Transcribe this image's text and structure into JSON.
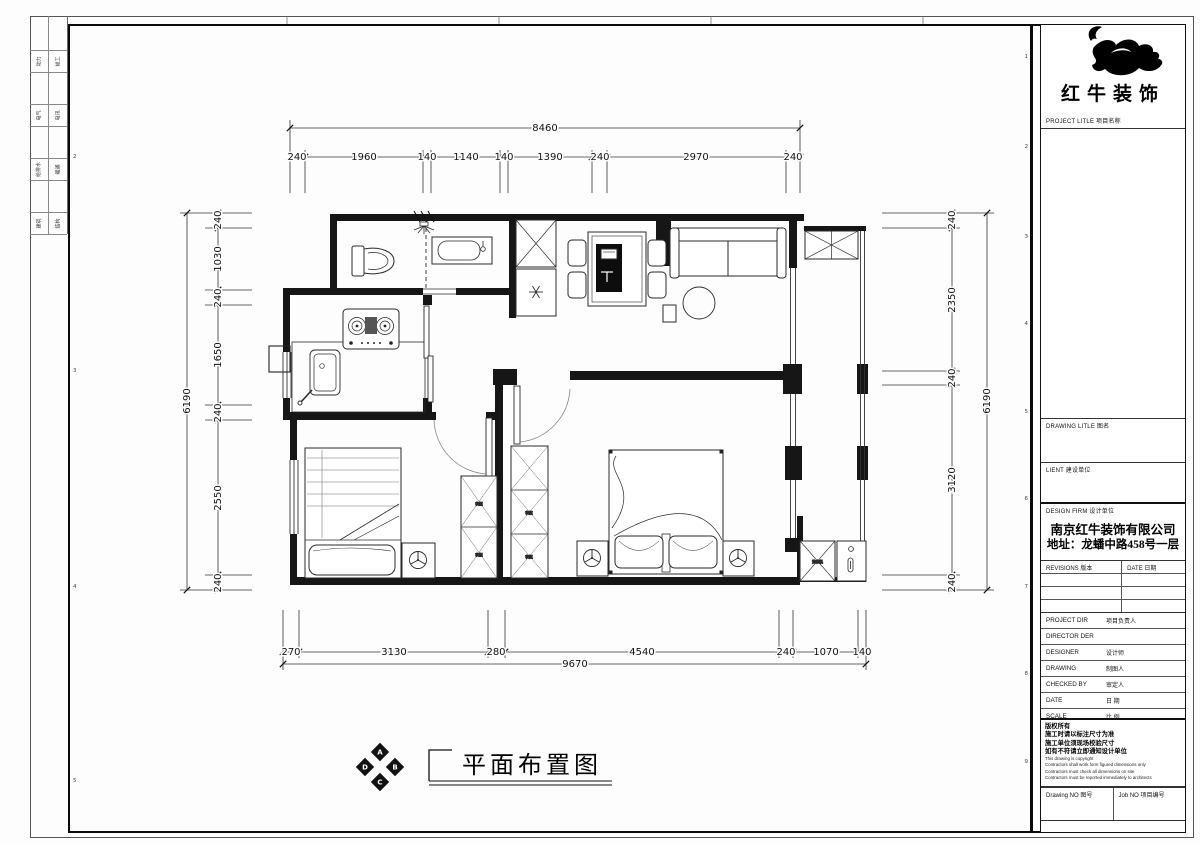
{
  "sheet": {
    "frame_numbers_right": [
      "1",
      "2",
      "3",
      "4",
      "5",
      "6",
      "7",
      "8",
      "9"
    ],
    "frame_numbers_left": [
      "2",
      "3",
      "4",
      "5"
    ],
    "discipline_strip": {
      "rows": [
        {
          "left": "动力",
          "right": "竣工"
        },
        {
          "left": "电气",
          "right": "电讯"
        },
        {
          "left": "给排水",
          "right": "暖通"
        },
        {
          "left": "建筑",
          "right": "结构"
        }
      ]
    }
  },
  "plan": {
    "title": "平面布置图",
    "compass": {
      "top": "A",
      "right": "B",
      "bottom": "C",
      "left": "D"
    },
    "labels": {
      "wardrobe": "衣柜",
      "washer": "洗衣机"
    },
    "dims": {
      "top": {
        "total": "8460",
        "segments": [
          "240",
          "1960",
          "140",
          "1140",
          "140",
          "1390",
          "240",
          "2970",
          "240"
        ]
      },
      "bottom": {
        "total": "9670",
        "segments": [
          "270",
          "3130",
          "280",
          "4540",
          "240",
          "1070",
          "140"
        ]
      },
      "left": {
        "total": "6190",
        "segments": [
          "240",
          "1030",
          "240",
          "1650",
          "240",
          "2550",
          "240"
        ]
      },
      "right": {
        "total": "6190",
        "segments": [
          "240",
          "2350",
          "240",
          "3120",
          "240"
        ]
      }
    }
  },
  "titleblock": {
    "brand": "红牛装饰",
    "project_title_label": "PROJECT LITLE  项目名称",
    "drawing_title_label": "DRAWING LITLE  图名",
    "client_label": "LIENT  建设单位",
    "design_firm_label": "DESIGN FIRM  设计单位",
    "company_name": "南京红牛装饰有限公司",
    "company_address": "地址：龙蟠中路458号一层",
    "revisions_label": "REVISIONS  版本",
    "revisions_date_label": "DATE  日期",
    "sign_rows": [
      {
        "en": "PROJECT DIR",
        "cn": "项目负责人"
      },
      {
        "en": "DIRECTOR DER",
        "cn": ""
      },
      {
        "en": "DESIGNER",
        "cn": "设计师"
      },
      {
        "en": "DRAWING",
        "cn": "制图人"
      },
      {
        "en": "CHECKED BY",
        "cn": "审定人"
      },
      {
        "en": "DATE",
        "cn": "日  期"
      },
      {
        "en": "SCALE",
        "cn": "比  例"
      }
    ],
    "copyright_lines": [
      "版权所有",
      "施工时请以标注尺寸为准",
      "施工单位须现场校验尺寸",
      "如有不符请立即通知设计单位",
      "This drawing is copyright",
      "Contractors shall work form figured dimensions only",
      "Contractors must check all dimensions on site",
      "Contractors must be reported immediately to architects"
    ],
    "drawing_no_label": "Drawing NO  图号",
    "job_no_label": "Job NO  项目编号"
  }
}
